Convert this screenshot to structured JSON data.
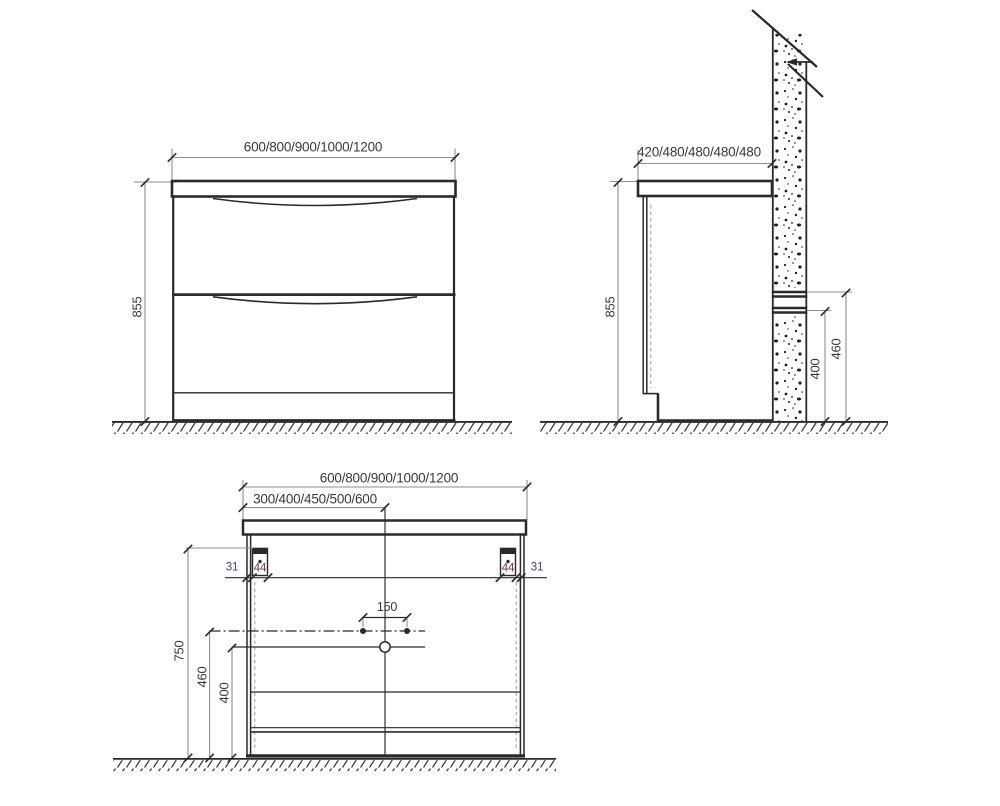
{
  "drawing_title": "vanity-cabinet-installation-dimensions",
  "views": {
    "front": {
      "width": "600/800/900/1000/1200",
      "height": "855"
    },
    "side": {
      "depth": "420/480/480/480/480",
      "height": "855",
      "wall_rail_upper_height": "460",
      "wall_rail_lower_height": "400"
    },
    "rear": {
      "width": "600/800/900/1000/1200",
      "center_offset": "300/400/450/500/600",
      "hole_spacing": "150",
      "bracket_line_height": "750",
      "upper_line_height": "460",
      "lower_line_height": "400",
      "bracket_inset_left": "31",
      "bracket_width_left": "44",
      "bracket_width_right": "44",
      "bracket_inset_right": "31"
    }
  },
  "colors": {
    "line": "#2a2a2a",
    "dimline": "#8e8e8e",
    "text": "#333a45",
    "accent-44": "#7a3b33",
    "accent-31": "#36457a",
    "bg": "#ffffff",
    "speckle": "#1f1f1f",
    "hatch": "#3d3d3d"
  }
}
